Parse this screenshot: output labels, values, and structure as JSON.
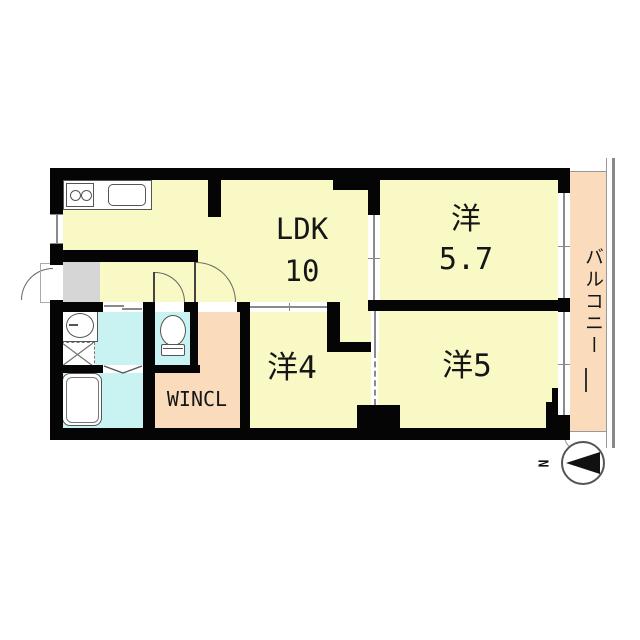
{
  "floorplan": {
    "rooms": {
      "ldk": {
        "name": "living-dining-kitchen",
        "label_line1": "LDK",
        "label_line2": "10"
      },
      "western_5_7": {
        "name": "western-room-5.7",
        "label_line1": "洋",
        "label_line2": "5.7"
      },
      "western_4": {
        "name": "western-room-4",
        "label": "洋4"
      },
      "western_5": {
        "name": "western-room-5",
        "label": "洋5"
      },
      "wincl": {
        "name": "walk-in-closet",
        "label": "WINCL"
      },
      "balcony": {
        "name": "balcony",
        "label": "バルコニー"
      }
    },
    "compass": {
      "label": "N"
    },
    "fixtures": [
      "kitchen-counter",
      "stove-burners",
      "kitchen-sink",
      "washbasin",
      "washing-machine-pan",
      "bathtub",
      "toilet"
    ],
    "colors": {
      "room_fill": "#f9f9c5",
      "wet_area_fill": "#c9f2f2",
      "closet_fill": "#fadcbd",
      "balcony_fill": "#fadcbd",
      "entrance_fill": "#d6d6d6",
      "wall": "#050505"
    }
  }
}
